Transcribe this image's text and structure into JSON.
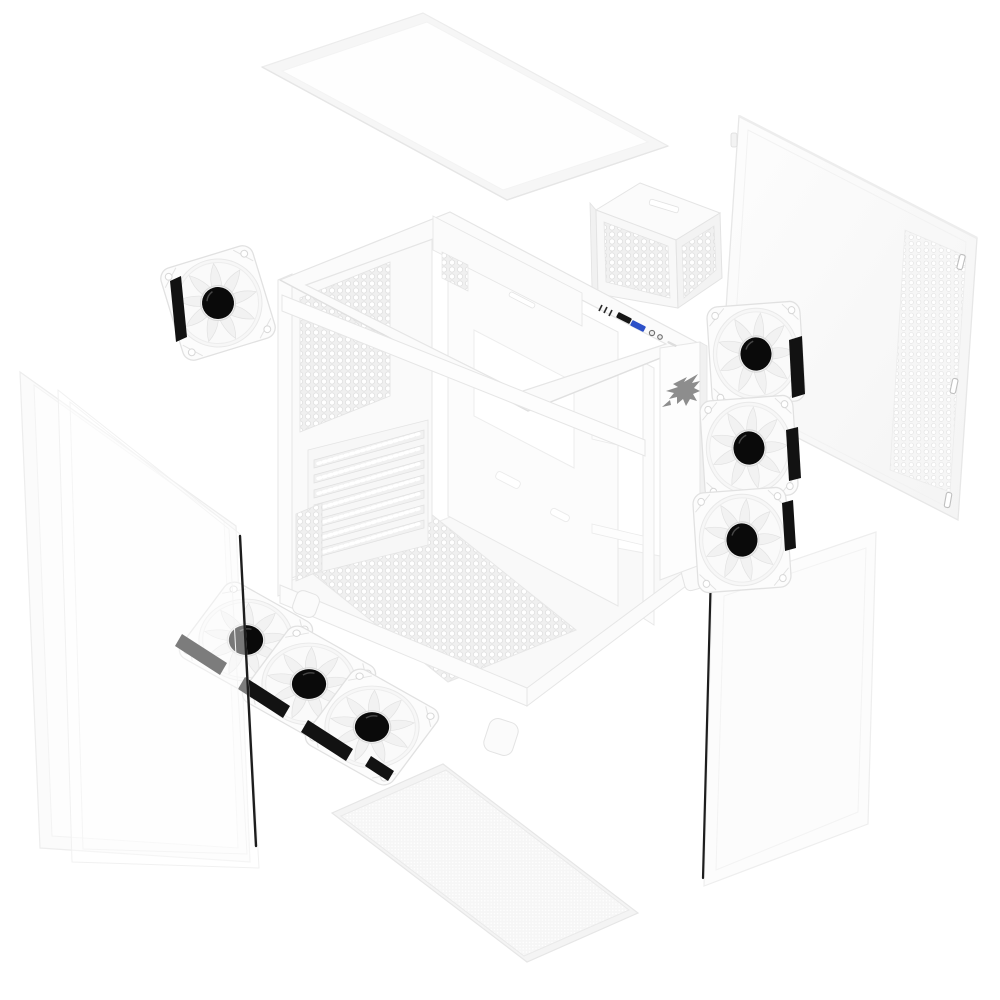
{
  "page": {
    "background": "#ffffff",
    "aria_label": "Exploded view product render of a white mid-tower PC case with tempered glass panels, vented steel side panel, PSU cage, bottom dust filter and seven white ARGB fans"
  },
  "colors": {
    "chassis_white": "#fbfbfb",
    "outline_gray": "#e5e5e5",
    "perforation_gray": "#efefef",
    "fan_hub_black": "#0a0a0a",
    "rubber_pad_black": "#121212",
    "glass_edge_black": "#1d1d1d",
    "usb_port_black": "#161616",
    "usb_port_blue": "#2c50c8",
    "audio_jack_gray": "#6e6e6e",
    "logo_gray": "#8d8d8d"
  },
  "components": {
    "top_panel": {
      "name": "tempered-glass-top-panel"
    },
    "side_panel": {
      "name": "vented-steel-side-panel",
      "clips": 3
    },
    "psu_cage": {
      "name": "perforated-psu-cage"
    },
    "rear_fan": {
      "name": "rear-120mm-argb-fan",
      "count": 1
    },
    "side_fan_column": {
      "name": "side-120mm-argb-fans",
      "count": 3
    },
    "bottom_fan_row": {
      "name": "bottom-120mm-argb-fans",
      "count": 3
    },
    "chassis": {
      "name": "main-chassis-frame",
      "pci_slots": 7
    },
    "left_glass_rear": {
      "name": "left-tempered-glass-panel"
    },
    "left_glass_front": {
      "name": "left-tempered-glass-panel-front"
    },
    "front_glass": {
      "name": "front-tempered-glass-panel"
    },
    "dust_filter": {
      "name": "bottom-mesh-dust-filter"
    }
  },
  "io_panel": {
    "name": "top-io-panel",
    "elements": [
      "led-pinholes",
      "usb-port-black",
      "usb-port-blue",
      "audio-jack",
      "audio-jack",
      "vent-slot"
    ]
  },
  "branding": {
    "logo_icon": "hawk-logo-icon",
    "color": "#8d8d8d"
  }
}
